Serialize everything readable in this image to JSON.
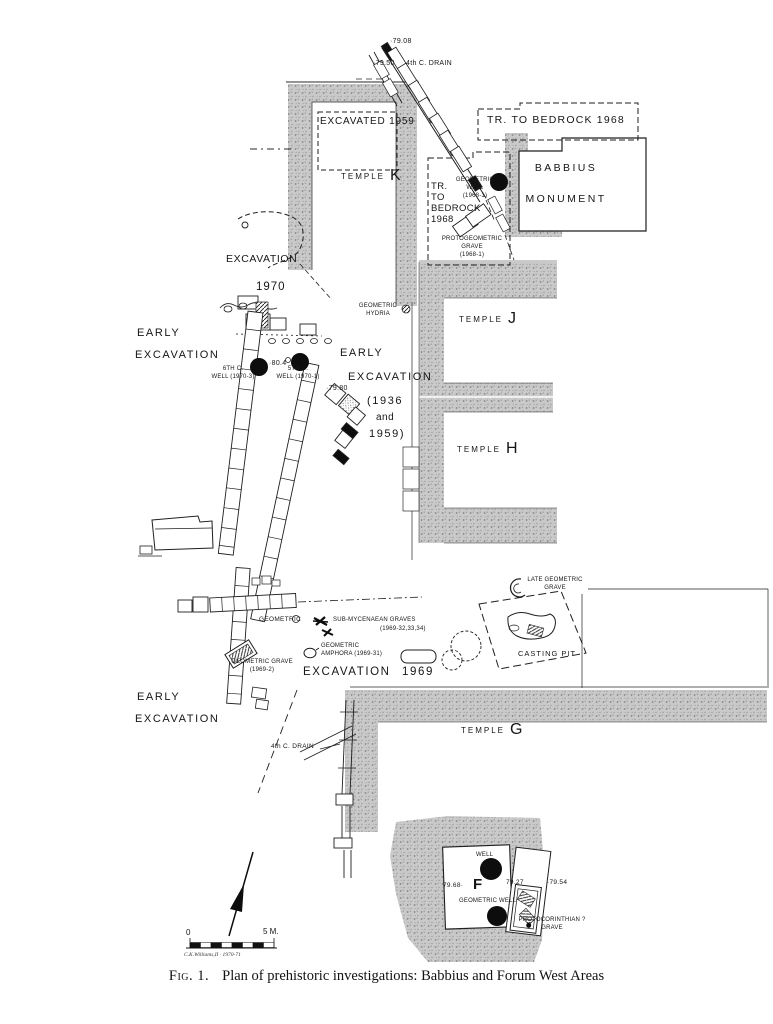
{
  "figure": {
    "caption_label": "Fig. 1.",
    "caption_text": "Plan of prehistoric investigations:  Babbius and Forum West Areas",
    "signature": "C.K.Williams,II · 1970-71"
  },
  "colors": {
    "ink": "#1a1a1a",
    "stipple_base": "#c9c9c9",
    "stipple_dot": "#8a8a8a",
    "paper": "#ffffff"
  },
  "scale_bar": {
    "zero": "0",
    "five_m": "5 M."
  },
  "temples": {
    "k": {
      "word": "TEMPLE",
      "letter": "K"
    },
    "j": {
      "word": "TEMPLE",
      "letter": "J"
    },
    "h": {
      "word": "TEMPLE",
      "letter": "H"
    },
    "g": {
      "word": "TEMPLE",
      "letter": "G"
    }
  },
  "labels": {
    "elev_79_08": "·79.08",
    "elev_79_50": "·79.50",
    "drain_top": "4th C. DRAIN",
    "tr_bedrock_top": "TR. TO BEDROCK 1968",
    "excavated_1959": "EXCAVATED 1959",
    "babbius": "BABBIUS\nMONUMENT",
    "tr_bedrock_side": "TR.\nTO\nBEDROCK\n1968",
    "geometric_well_1968": "GEOMETRIC\nWELL\n(1968-1)",
    "protogeometric_grave": "PROTOGEOMETRIC\nGRAVE\n(1968-1)",
    "excavation_1970_line1": "EXCAVATION",
    "excavation_1970_line2": "1970",
    "geometric_hydria": "GEOMETRIC\nHYDRIA",
    "early_left_line1": "EARLY",
    "early_left_line2": "EXCAVATION",
    "well_6th": "6TH C.\nWELL (1970-3)",
    "elev_80_4": "·80.4",
    "well_5th": "5TH C.\nWELL (1970-1)",
    "elev_79_80": "·79.80",
    "early_mid_line1": "EARLY",
    "early_mid_line2": "EXCAVATION",
    "early_mid_line3": "(1936",
    "early_mid_line4": "and",
    "early_mid_line5": "1959)",
    "late_geometric_grave": "LATE GEOMETRIC\nGRAVE",
    "geometric_mid": "GEOMETRIC",
    "sub_mycenaean_line1": "SUB-MYCENAEAN GRAVES",
    "sub_mycenaean_line2": "(1969-32,33,34)",
    "geometric_amphora": "GEOMETRIC\nAMPHORA (1969-31)",
    "geometric_grave_1969": "GEOMETRIC GRAVE\n(1969-2)",
    "excavation_1969_word": "EXCAVATION",
    "excavation_1969_year": "1969",
    "casting_pit": "CASTING PIT",
    "early_bottom_line1": "EARLY",
    "early_bottom_line2": "EXCAVATION",
    "drain_bottom": "4th C. DRAIN",
    "well_f": "WELL",
    "elev_79_68": "79.68·",
    "building_f_letter": "F",
    "geometric_well_f": "GEOMETRIC WELL",
    "elev_79_27": "79.27",
    "elev_79_54": "·79.54",
    "protocorinthian_grave": "PROTOCORINTHIAN ?\nGRAVE"
  }
}
